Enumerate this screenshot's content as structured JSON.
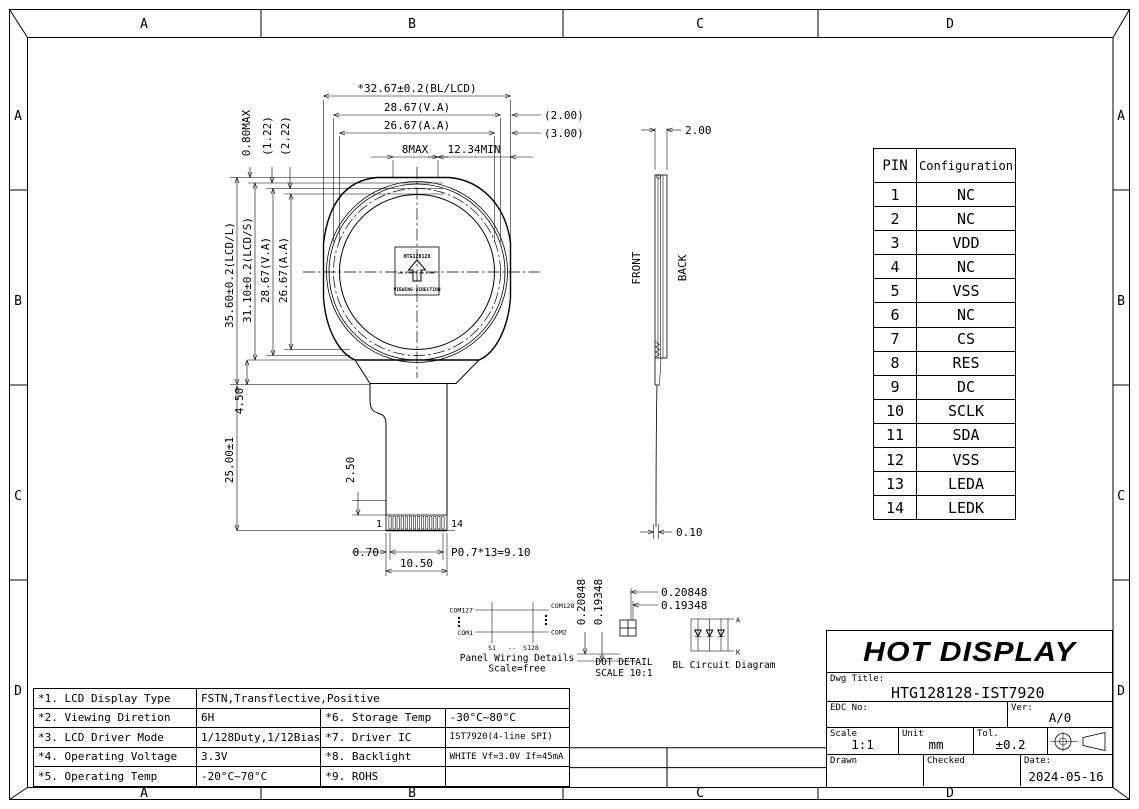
{
  "colors": {
    "line": "#000000",
    "paper": "#ffffff"
  },
  "zones": [
    "A",
    "B",
    "C",
    "D"
  ],
  "front_view": {
    "dim_width_bl_lcd": "*32.67±0.2(BL/LCD)",
    "dim_width_va": "28.67(V.A)",
    "dim_width_aa": "26.67(A.A)",
    "dim_8max": "8MAX",
    "dim_12_34min": "12.34MIN",
    "dim_2_00": "(2.00)",
    "dim_3_00": "(3.00)",
    "dim_0_80max": "0.80MAX",
    "dim_1_22": "(1.22)",
    "dim_2_22": "(2.22)",
    "dim_height_lcd_l": "35.60±0.2(LCD/L)",
    "dim_height_lcd_s": "31.10±0.2(LCD/S)",
    "dim_height_va": "28.67(V.A)",
    "dim_height_aa": "26.67(A.A)",
    "dim_ledge": "4.50",
    "dim_fpc_length": "25.00±1",
    "dim_pad_height": "2.50",
    "dim_pad_offset": "0.70",
    "dim_fpc_width": "10.50",
    "dim_pad_pitch": "P0.7*13=9.10",
    "pad_first": "1",
    "pad_last": "14",
    "label_box_top": "HTG128128",
    "label_box_bottom": "VIEWING DIRECTION"
  },
  "side_view": {
    "dim_thickness": "2.00",
    "front_label": "FRONT",
    "back_label": "BACK",
    "dim_fpc_thickness": "0.10"
  },
  "dot_detail": {
    "dim_width": "0.20848",
    "dim_height": "0.19348",
    "title": "DOT DETAIL",
    "scale": "SCALE 10:1"
  },
  "panel_wiring": {
    "com_top_left": "COM127",
    "com_bottom_left": "COM1",
    "com_top_right": "COM128",
    "com_bottom_right": "COM2",
    "seg_first": "S1",
    "seg_dash": "--",
    "seg_last": "S128",
    "title": "Panel Wiring Details",
    "scale": "Scale=free"
  },
  "bl_circuit": {
    "anode": "A",
    "cathode": "K",
    "title": "BL Circuit Diagram"
  },
  "pin_table": {
    "headers": [
      "PIN",
      "Configuration"
    ],
    "rows": [
      {
        "pin": "1",
        "config": "NC"
      },
      {
        "pin": "2",
        "config": "NC"
      },
      {
        "pin": "3",
        "config": "VDD"
      },
      {
        "pin": "4",
        "config": "NC"
      },
      {
        "pin": "5",
        "config": "VSS"
      },
      {
        "pin": "6",
        "config": "NC"
      },
      {
        "pin": "7",
        "config": "CS"
      },
      {
        "pin": "8",
        "config": "RES"
      },
      {
        "pin": "9",
        "config": "DC"
      },
      {
        "pin": "10",
        "config": "SCLK"
      },
      {
        "pin": "11",
        "config": "SDA"
      },
      {
        "pin": "12",
        "config": "VSS"
      },
      {
        "pin": "13",
        "config": "LEDA"
      },
      {
        "pin": "14",
        "config": "LEDK"
      }
    ]
  },
  "spec_table": {
    "rows": [
      {
        "l_label": "*1. LCD Display Type",
        "l_value": "FSTN,Transflective,Positive",
        "r_label": "",
        "r_value": ""
      },
      {
        "l_label": "*2. Viewing Diretion",
        "l_value": "6H",
        "r_label": "*6. Storage Temp",
        "r_value": "-30°C~80°C"
      },
      {
        "l_label": "*3. LCD Driver Mode",
        "l_value": "1/128Duty,1/12Bias",
        "r_label": "*7. Driver IC",
        "r_value": "IST7920(4-line SPI)"
      },
      {
        "l_label": "*4. Operating Voltage",
        "l_value": "3.3V",
        "r_label": "*8. Backlight",
        "r_value": "WHITE Vf=3.0V If=45mA"
      },
      {
        "l_label": "*5. Operating Temp",
        "l_value": "-20°C~70°C",
        "r_label": "*9. ROHS",
        "r_value": ""
      }
    ]
  },
  "title_block": {
    "logo": "HOT DISPLAY",
    "dwg_title_label": "Dwg Title:",
    "dwg_title": "HTG128128-IST7920",
    "edc_no_label": "EDC No:",
    "edc_no": "",
    "ver_label": "Ver:",
    "ver": "A/0",
    "scale_label": "Scale",
    "scale": "1:1",
    "unit_label": "Unit",
    "unit": "mm",
    "tol_label": "Tol.",
    "tol": "±0.2",
    "drawn_label": "Drawn",
    "checked_label": "Checked",
    "date_label": "Date:",
    "date": "2024-05-16"
  }
}
